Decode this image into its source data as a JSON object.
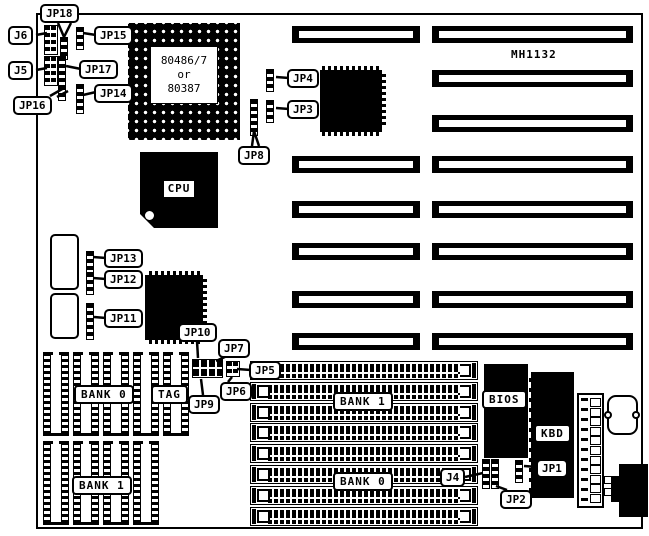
{
  "diagram": {
    "model": "MH1132",
    "cpu_socket": {
      "line1": "80486/7",
      "line2": "or",
      "line3": "80387"
    },
    "cpu_label": "CPU",
    "bios_label": "BIOS",
    "kbd_label": "KBD",
    "cache": {
      "bank0": "BANK 0",
      "tag": "TAG",
      "bank1": "BANK 1"
    },
    "simm": {
      "bank1": "BANK 1",
      "bank0": "BANK 0"
    },
    "callouts": {
      "jp18": "JP18",
      "j6": "J6",
      "jp15": "JP15",
      "j5": "J5",
      "jp17": "JP17",
      "jp16": "JP16",
      "jp14": "JP14",
      "jp4": "JP4",
      "jp3": "JP3",
      "jp8": "JP8",
      "jp13": "JP13",
      "jp12": "JP12",
      "jp11": "JP11",
      "jp10": "JP10",
      "jp7": "JP7",
      "jp5": "JP5",
      "jp6": "JP6",
      "jp9": "JP9",
      "j4": "J4",
      "jp1": "JP1",
      "jp2": "JP2"
    },
    "colors": {
      "ink": "#000000",
      "paper": "#ffffff"
    }
  }
}
